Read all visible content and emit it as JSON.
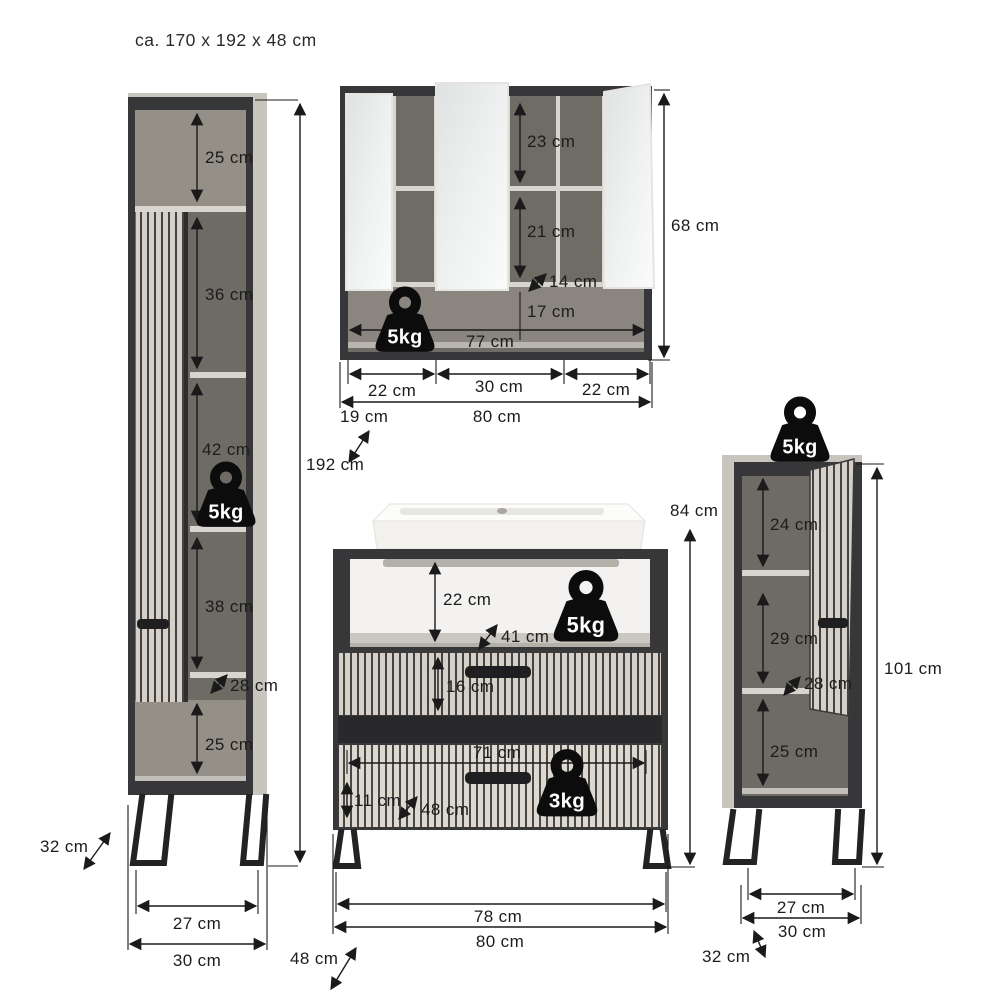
{
  "title": "ca. 170 x 192 x 48 cm",
  "tall_cabinet": {
    "max_load": "5kg",
    "dims": {
      "top_compartment_height": "25 cm",
      "compartment2_height": "36 cm",
      "compartment3_height": "42 cm",
      "compartment4_height": "38 cm",
      "bottom_compartment_height": "25 cm",
      "inner_depth": "28 cm",
      "total_height": "192 cm",
      "leg_span": "27 cm",
      "width": "30 cm",
      "depth": "32 cm"
    }
  },
  "mirror_cabinet": {
    "max_load": "5kg",
    "dims": {
      "top_compartment_height": "23 cm",
      "middle_compartment_height": "21 cm",
      "shelf_depth": "14 cm",
      "bottom_shelf_height": "17 cm",
      "inner_width": "77 cm",
      "left_section_width": "22 cm",
      "center_section_width": "30 cm",
      "right_section_width": "22 cm",
      "total_width": "80 cm",
      "depth": "19 cm",
      "height": "68 cm"
    }
  },
  "vanity": {
    "max_load_top": "5kg",
    "max_load_drawer": "3kg",
    "dims": {
      "total_height": "84 cm",
      "open_compartment_height": "22 cm",
      "open_compartment_depth": "41 cm",
      "drawer1_front_height": "16 cm",
      "drawer_inner_width": "71 cm",
      "drawer2_inner_height": "11 cm",
      "drawer_inner_depth": "48 cm",
      "leg_span": "78 cm",
      "total_width": "80 cm",
      "depth": "48 cm"
    }
  },
  "side_cabinet": {
    "max_load": "5kg",
    "dims": {
      "top_compartment_height": "24 cm",
      "middle_compartment_height": "29 cm",
      "inner_depth": "28 cm",
      "bottom_compartment_height": "25 cm",
      "total_height": "101 cm",
      "leg_span": "27 cm",
      "width": "30 cm",
      "depth": "32 cm"
    }
  },
  "colors": {
    "frame": "#37373a",
    "interior": "#6e6b64",
    "panel_light": "#c8c5be",
    "flute_light": "#d4d0c7",
    "dimension": "#1a1a1a",
    "badge": "#0c0c0c"
  }
}
